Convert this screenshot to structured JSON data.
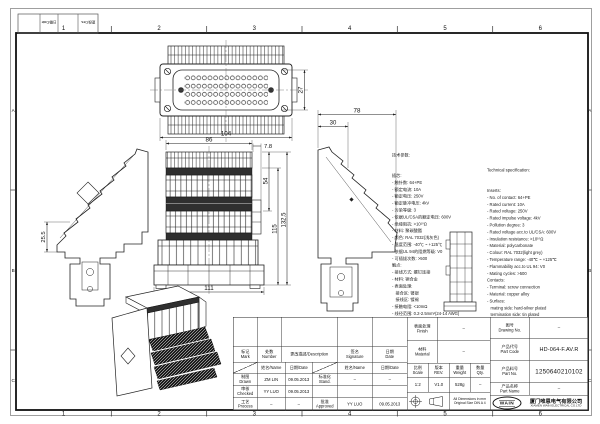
{
  "frame": {
    "zone_numbers": [
      "1",
      "2",
      "3",
      "4",
      "5",
      "6"
    ],
    "zone_letters": [
      "A",
      "B",
      "C"
    ],
    "rev_strip": [
      "日期/Date",
      "更改/Des."
    ]
  },
  "dimensions": {
    "top_width": "104",
    "insert_height": "27",
    "front_width": "86",
    "base_width": "111",
    "flange": "7.8",
    "terminal_height": "54",
    "mid_height": "115",
    "total_height": "132.5",
    "side_depth": "78",
    "side_inner": "30",
    "left_offset": "25.5"
  },
  "specs_cn": {
    "title": "技术参数:",
    "lines": [
      "插芯:",
      "- 触针数: 64+PE",
      "- 额定电流: 10A",
      "- 额定电压: 250V",
      "- 额定脉冲电压: 4kV",
      "- 污染等级: 3",
      "- 依据UL/CSA的额定电压: 600V",
      "- 绝缘阻抗: >10¹⁰Ω",
      "- 材料: 聚碳酸酯",
      "- 颜色: RAL 7032(浅灰色)",
      "- 温度范围: -40℃ ~ +125℃",
      "- 依据UL 94的阻燃等级: V0",
      "- 可插拔次数: >500",
      "触点:",
      "- 接线方式: 螺钉连接",
      "- 材料: 铜合金",
      "- 表面处理:",
      "   接合区: 镀银",
      "   接线区: 镀锡",
      "- 接触电阻: <10mΩ",
      "- 线径范围: 0.2-2.5mm²(24-14 AWG)",
      "- 拧紧/松开力矩: 0.5Nm"
    ]
  },
  "specs_en": {
    "title": "Technical specification:",
    "lines": [
      "Inserts:",
      "- No. of contact: 64+PE",
      "- Rated current: 10A",
      "- Rated voltage: 250V",
      "- Rated impulse voltage: 4kV",
      "- Pollution degree: 3",
      "- Rated voltage acc.to UL/CSA: 600V",
      "- Insulation resistance: >10¹⁰Ω",
      "- Material: polycarbonate",
      "- Colour: RAL 7032(light grey)",
      "- Temperature range: -40℃ ~ +125℃",
      "- Flammability acc.to UL 94: V0",
      "- Mating cycles: >500",
      "Contacts:",
      "- Terminal: screw connection",
      "- Material: copper alloy",
      "- Surface:",
      "   mating side: hard-silver plated",
      "   termination side: tin plated",
      "- Contact resistance: <10mΩ",
      "- Wire gauge: 0.2-2.5mm²(24-14 AWG)",
      "- Tightening/test torque: 0.5Nm"
    ]
  },
  "title_block": {
    "revision_header": {
      "mark": "标记\nMark",
      "number": "处数\nNumber",
      "description": "更改描述/Description",
      "signature": "签名\nSignature",
      "date": "日期\nDate"
    },
    "sub_header": {
      "name": "姓名/Name",
      "date": "日期/Date"
    },
    "rows": {
      "drawn_label": "制图\nDrawn",
      "drawn_name": "ZM LIN",
      "drawn_date": "09.05.2013",
      "stand_label": "标准化\nStand.",
      "stand_name": "–",
      "stand_date": "–",
      "checked_label": "审核\nChecked",
      "checked_name": "YY LUO",
      "checked_date": "09.05.2013",
      "process_label": "工艺\nProcess",
      "process_name": "–",
      "process_date": "–",
      "approved_label": "批准\nApproved",
      "approved_name": "YY LUO",
      "approved_date": "09.05.2013"
    },
    "finish_label": "表面处理\nFinish",
    "finish_value": "–",
    "material_label": "材料\nMaterial",
    "material_value": "–",
    "scale_label": "比例\nScale",
    "scale_value": "1:2",
    "rev_label": "版本\nREV.",
    "rev_value": "V1.0",
    "weight_label": "重量\nWeight",
    "weight_value": "528g",
    "qty_label": "数量\nQty.",
    "qty_value": "–",
    "note_line1": "All Dimensions in mm",
    "note_line2": "Original Size DIN A 4",
    "drawing_no_label": "图号\nDrawing No.",
    "drawing_no_value": "–",
    "part_code_label": "产品代号\nPart Code",
    "part_code_value": "HD-064-F.AV.R",
    "part_no_label": "产品料号\nPart No.",
    "part_no_value": "1250640210102",
    "part_name_label": "产品名称\nPart Name",
    "part_name_value": "–",
    "company_logo": "WAIN",
    "company_cn": "厦门唯恩电气有限公司",
    "company_en": "XIAMEN WAIN ELECTRICAL CO.LTD"
  }
}
